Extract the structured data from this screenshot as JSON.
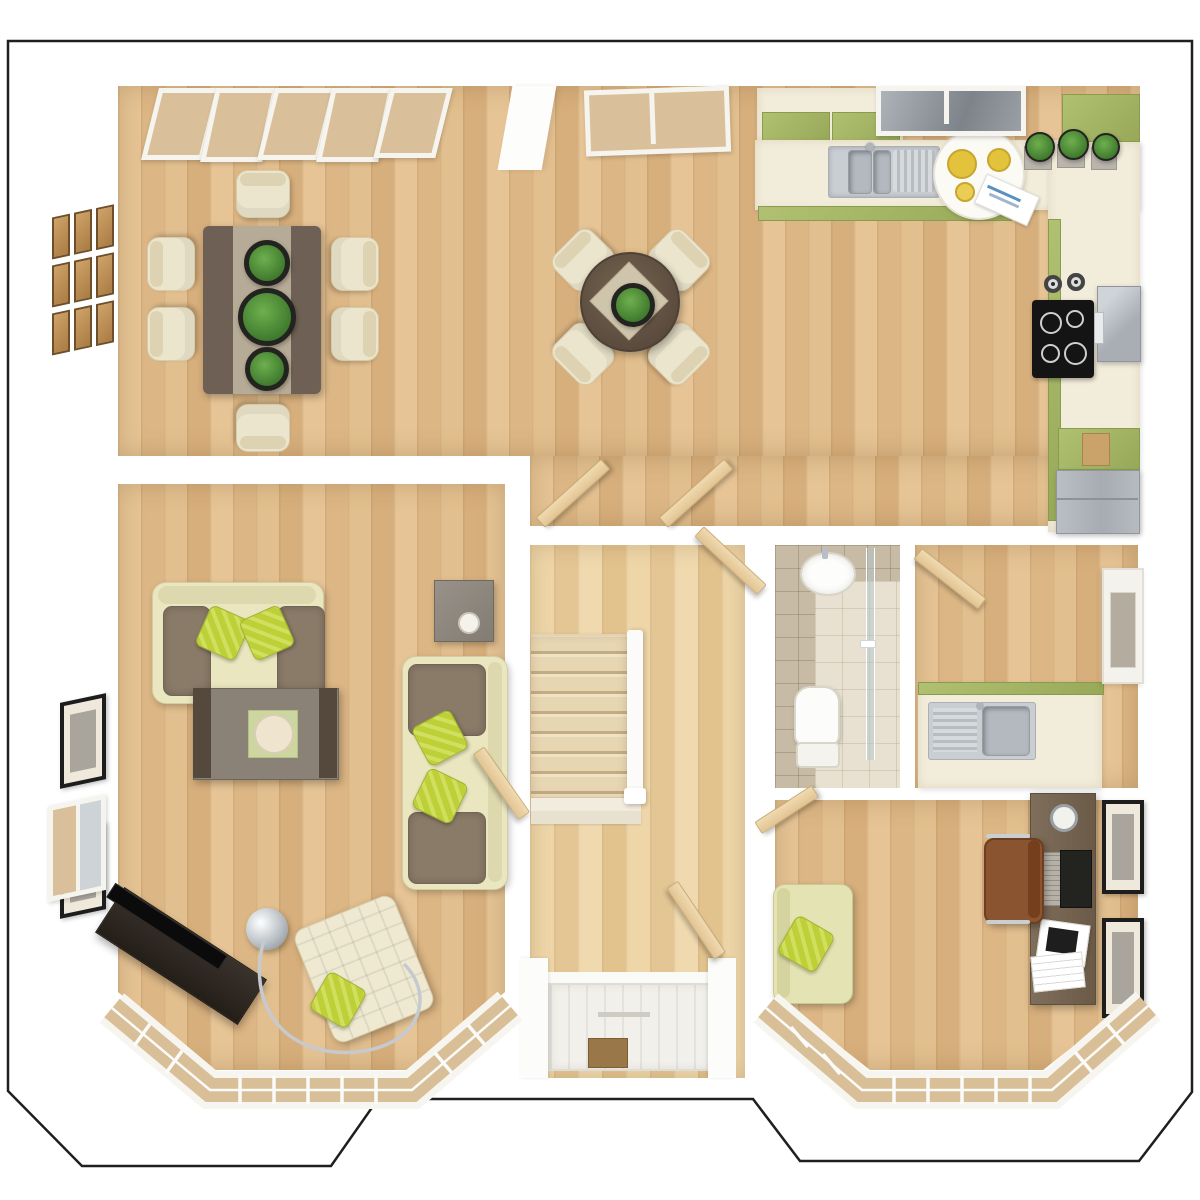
{
  "scene": {
    "kind": "3d-floorplan-top-view",
    "floor": "ground-floor",
    "style": "architectural render, no text labels"
  },
  "colors": {
    "background": "#ffffff",
    "outline": "#1f1f1f",
    "wall": "#f7f6f3",
    "floor_wood": "#e3c091",
    "floor_hall": "#edd3a4",
    "carpet_stairs": "#e7d6b2",
    "cabinet_green": "#a3b464",
    "counter_cream": "#f2ecda",
    "steel": "#c9ced3",
    "sofa_cream": "#eae6c0",
    "cushion_brown": "#8a7a68",
    "pillow_green": "#bdd037",
    "table_dark": "#6e6054",
    "table_runner": "#b6ab96",
    "door_wood": "#e8cfa2",
    "tile": "#c8bba6",
    "tile_floor": "#e8e1d1",
    "desk_wood": "#76664f",
    "leather_brown": "#8a5430",
    "tv_black": "#101010",
    "glass_tan": "#d9c09a",
    "glass_gray": "#9aa0a4",
    "frame_black": "#1d1d1d",
    "plant_green": "#4e8c3a",
    "mat_brown": "#9a7748"
  },
  "rooms": [
    {
      "name": "dining-area",
      "position": "top-left",
      "furniture": [
        "folding-french-doors",
        "wood-panel-wall-art-3x3",
        "dining-table-with-runner",
        "plant-centerpieces-x3",
        "dining-chairs-x6"
      ]
    },
    {
      "name": "breakfast-area",
      "position": "top-center",
      "furniture": [
        "casement-window",
        "round-table",
        "diamond-placemat",
        "potted-plant",
        "chairs-x4"
      ]
    },
    {
      "name": "kitchen",
      "position": "top-right",
      "furniture": [
        "window-gray-glass",
        "wall-cabinets",
        "l-shaped-counter",
        "double-sink-with-drainer",
        "tap",
        "serving-tray",
        "plates",
        "magazine",
        "herb-pots-x3",
        "canisters-x2",
        "hob-4-ring",
        "oven-extractor",
        "green-base-cabinets",
        "cutting-board",
        "fridge-freezer"
      ]
    },
    {
      "name": "living-room",
      "position": "left",
      "furniture": [
        "sofa-3-seat",
        "sofa-2-seat",
        "striped-pillows-x4",
        "brown-cushions-x4",
        "coffee-table-with-tray",
        "side-table-with-candle",
        "tv-unit-angled",
        "tv-flatscreen",
        "arc-floor-lamp",
        "tufted-armchair",
        "framed-pictures-x2",
        "side-window",
        "bay-window"
      ]
    },
    {
      "name": "hallway",
      "position": "center",
      "furniture": [
        "carpeted-staircase",
        "white-banister",
        "front-door",
        "doormat",
        "open-door-leaves"
      ]
    },
    {
      "name": "cloakroom-wc",
      "position": "center-right",
      "furniture": [
        "tiled-walls",
        "wash-basin",
        "toilet",
        "glass-shower-screen"
      ]
    },
    {
      "name": "utility-room",
      "position": "right",
      "furniture": [
        "open-door",
        "counter-green-splashback",
        "steel-sink-with-drainer",
        "back-door-glazed"
      ]
    },
    {
      "name": "study",
      "position": "bottom-right",
      "furniture": [
        "desk-dark-wood",
        "laptop",
        "tablet",
        "papers",
        "desk-accessory",
        "leather-office-chair",
        "green-armchair",
        "striped-pillow",
        "framed-pictures-x2",
        "entry-door",
        "bay-window"
      ]
    }
  ],
  "openings": {
    "bay_windows": 2,
    "top_wall_windows": 3,
    "internal_open_doors": 7,
    "front_door": 1,
    "back_door": 1
  }
}
